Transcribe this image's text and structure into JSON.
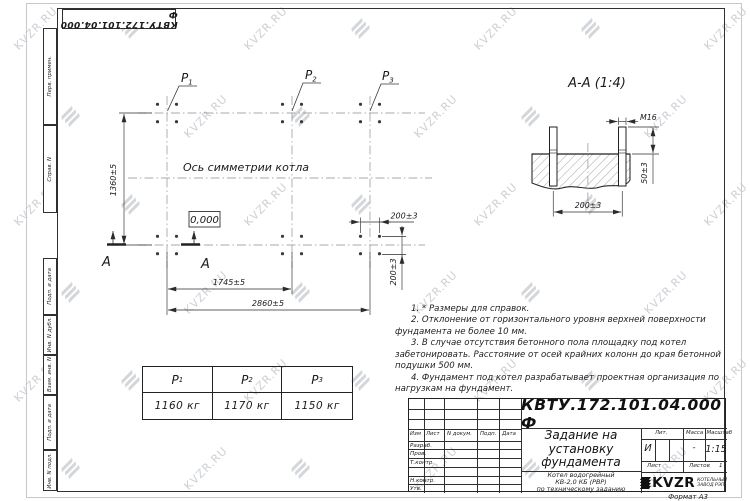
{
  "watermark": {
    "text": "KVZR.RU"
  },
  "corner_stamp": {
    "number": "КВТУ.172.101.04.000 Ф"
  },
  "margin_fields": {
    "items": [
      {
        "label": "Перв. примен."
      },
      {
        "label": "Справ. N"
      },
      {
        "label": "Подп. и дата"
      },
      {
        "label": "Инв. N дубл."
      },
      {
        "label": "Взам. инв. N"
      },
      {
        "label": "Подп. и дата"
      },
      {
        "label": "Инв. N подл."
      }
    ]
  },
  "plan": {
    "symmetry_axis_label": "Ось симметрии котла",
    "level_mark": "0,000",
    "section_letter": "А",
    "p_labels": [
      {
        "name": "P",
        "sub": "1"
      },
      {
        "name": "P",
        "sub": "2"
      },
      {
        "name": "P",
        "sub": "3"
      }
    ],
    "dim_height": "1360±5",
    "dim_span_p1p2": "1745±5",
    "dim_span_total": "2860±5",
    "dim_bolt_x": "200±3",
    "dim_bolt_y": "200±3"
  },
  "section_view": {
    "title": "А-А (1:4)",
    "thread_label": "М16",
    "dim_protrusion": "50±3",
    "dim_bolt_spacing": "200±3"
  },
  "loads_table": {
    "columns": [
      {
        "name": "P",
        "sub": "1",
        "value": "1160 кг"
      },
      {
        "name": "P",
        "sub": "2",
        "value": "1170 кг"
      },
      {
        "name": "P",
        "sub": "3",
        "value": "1150 кг"
      }
    ]
  },
  "notes": {
    "items": [
      "1. * Размеры для справок.",
      "2. Отклонение от горизонтального уровня верхней поверхности фундамента не более 10 мм.",
      "3. В случае отсутствия бетонного пола площадку под котел забетонировать. Расстояние от осей крайних колонн до края бетонной подушки 500 мм.",
      "4. Фундамент под котел разрабатывает проектная организация по нагрузкам на фундамент."
    ]
  },
  "title_block": {
    "doc_number": "КВТУ.172.101.04.000 Ф",
    "title_line1": "Задание на",
    "title_line2": "установку",
    "title_line3": "фундамента",
    "subject_line1": "Котел водогрейный",
    "subject_line2": "КВ-2,0 КБ (РВР)",
    "subject_line3": "по техническому заданию",
    "header": {
      "izm": "Изм",
      "list": "Лист",
      "ndok": "N докум.",
      "podp": "Подп.",
      "data": "Дата"
    },
    "rows": {
      "r1": "Разраб.",
      "r2": "Пров.",
      "r3": "Т.контр.",
      "r4": "Н.контр.",
      "r5": "Утв."
    },
    "lit": {
      "label": "Лит.",
      "value": "И"
    },
    "mass": {
      "label": "Масса",
      "value": "-"
    },
    "scale": {
      "label": "Масштаб",
      "value": "1:15"
    },
    "sheet_label": "Лист",
    "sheets_label": "Листов",
    "sheets_value": "1",
    "company": {
      "logo": "KVZR",
      "line1": "КОТЕЛЬНЫЙ",
      "line2": "ЗАВОД РЭП"
    },
    "format_label": "Формат А3"
  }
}
